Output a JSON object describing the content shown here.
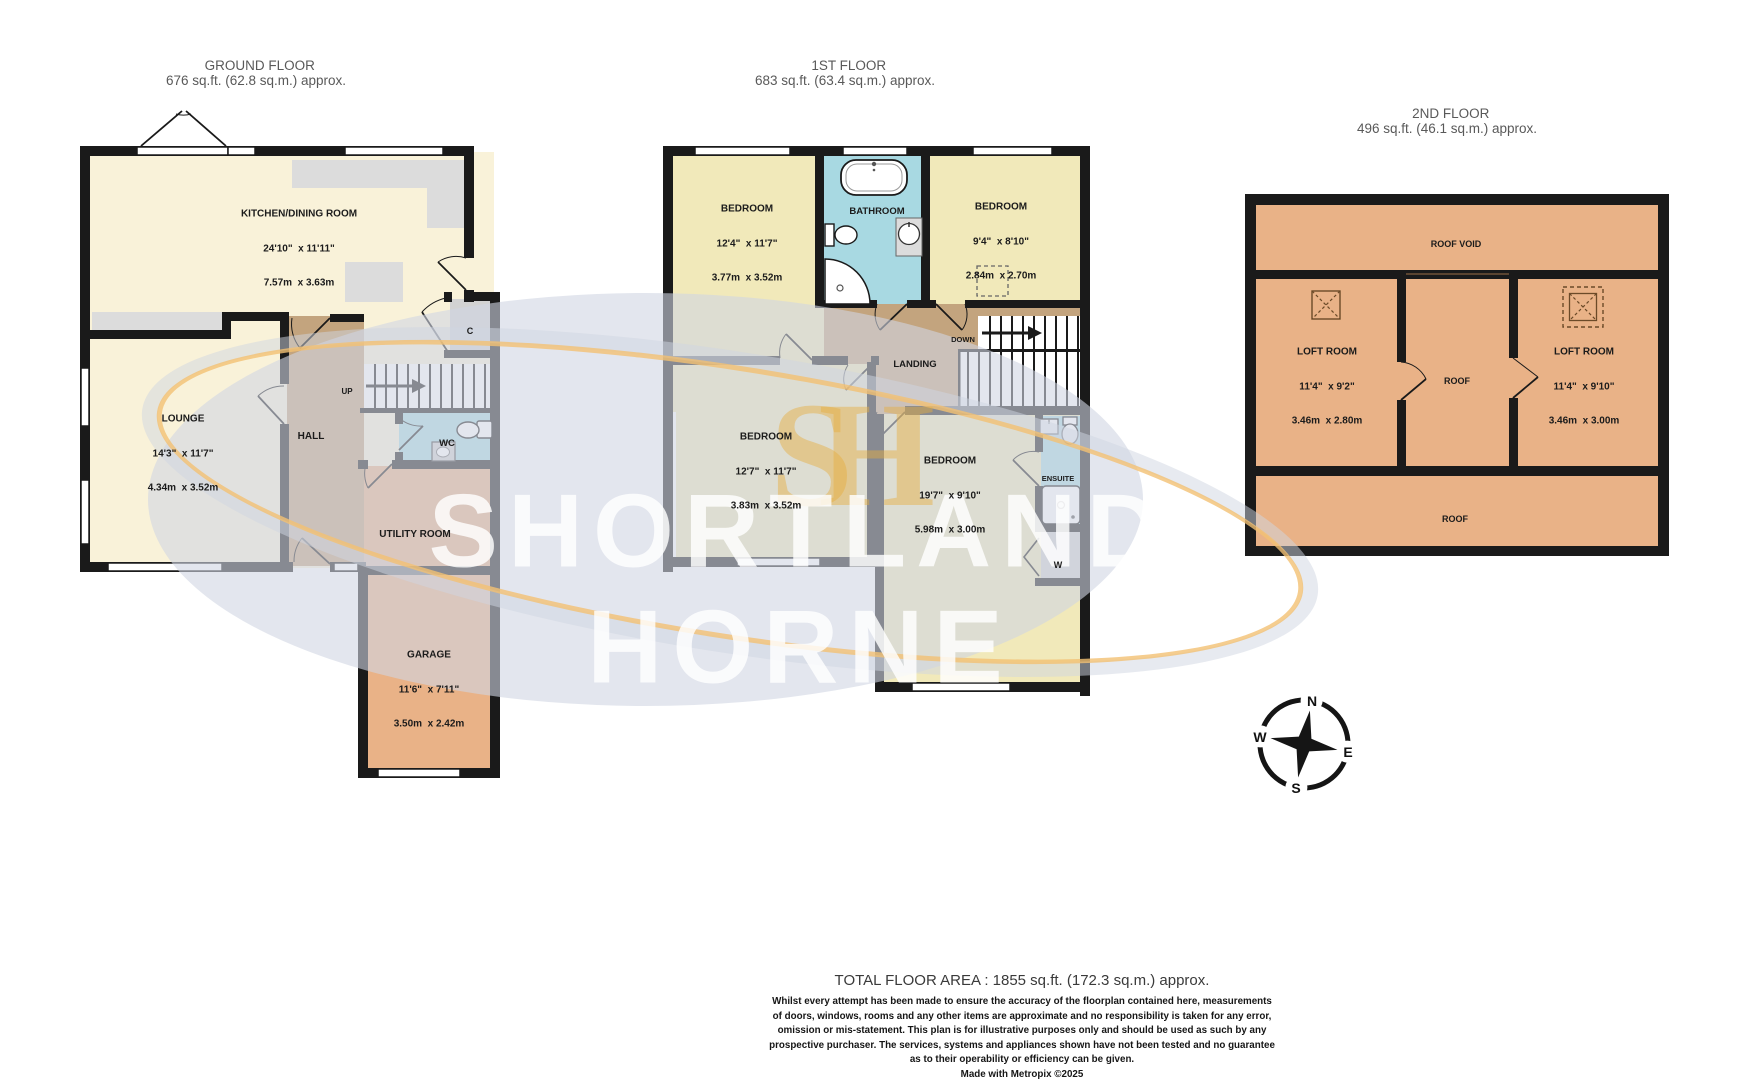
{
  "watermark": {
    "line1": "SHORTLAND",
    "line2": "HORNE",
    "monogram": "SH"
  },
  "compass": {
    "north": "N",
    "east": "E",
    "south": "S",
    "west": "W"
  },
  "floors": {
    "ground": {
      "title": "GROUND FLOOR",
      "area": "676 sq.ft. (62.8 sq.m.) approx.",
      "kitchen": {
        "name": "KITCHEN/DINING ROOM",
        "imperial": "24'10\"  x 11'11\"",
        "metric": "7.57m  x 3.63m"
      },
      "lounge": {
        "name": "LOUNGE",
        "imperial": "14'3\"  x 11'7\"",
        "metric": "4.34m  x 3.52m"
      },
      "hall": {
        "name": "HALL"
      },
      "stairs_label": "UP",
      "wc": {
        "name": "WC"
      },
      "cupboard": {
        "name": "C"
      },
      "utility": {
        "name": "UTILITY ROOM"
      },
      "garage": {
        "name": "GARAGE",
        "imperial": "11'6\"  x 7'11\"",
        "metric": "3.50m  x 2.42m"
      }
    },
    "first": {
      "title": "1ST FLOOR",
      "area": "683 sq.ft. (63.4 sq.m.) approx.",
      "bedroom1": {
        "name": "BEDROOM",
        "imperial": "12'4\"  x 11'7\"",
        "metric": "3.77m  x 3.52m"
      },
      "bathroom": {
        "name": "BATHROOM"
      },
      "bedroom2": {
        "name": "BEDROOM",
        "imperial": "9'4\"  x 8'10\"",
        "metric": "2.84m  x 2.70m"
      },
      "landing": {
        "name": "LANDING"
      },
      "stairs_label": "DOWN",
      "bedroom3": {
        "name": "BEDROOM",
        "imperial": "12'7\"  x 11'7\"",
        "metric": "3.83m  x 3.52m"
      },
      "bedroom4": {
        "name": "BEDROOM",
        "imperial": "19'7\"  x 9'10\"",
        "metric": "5.98m  x 3.00m"
      },
      "ensuite": {
        "name": "ENSUITE"
      },
      "wardrobe": {
        "name": "W"
      }
    },
    "second": {
      "title": "2ND FLOOR",
      "area": "496 sq.ft. (46.1 sq.m.) approx.",
      "roof_void": {
        "name": "ROOF VOID"
      },
      "loft_left": {
        "name": "LOFT ROOM",
        "imperial": "11'4\"  x 9'2\"",
        "metric": "3.46m  x 2.80m"
      },
      "roof_mid": {
        "name": "ROOF"
      },
      "loft_right": {
        "name": "LOFT ROOM",
        "imperial": "11'4\"  x 9'10\"",
        "metric": "3.46m  x 3.00m"
      },
      "roof_bottom": {
        "name": "ROOF"
      }
    }
  },
  "footer": {
    "total": "TOTAL FLOOR AREA : 1855 sq.ft. (172.3 sq.m.) approx.",
    "disclaimer": [
      "Whilst every attempt has been made to ensure the accuracy of the floorplan contained here, measurements",
      "of doors, windows, rooms and any other items are approximate and no responsibility is taken for any error,",
      "omission or mis-statement. This plan is for illustrative purposes only and should be used as such by any",
      "prospective purchaser. The services, systems and appliances shown have not been tested and no guarantee",
      "as to their operability or efficiency can be given.",
      "Made with Metropix ©2025"
    ]
  },
  "colors": {
    "wall": "#1a1a1a",
    "cream": "#f9f2d9",
    "yellow": "#f1e9ba",
    "tan": "#c3a47e",
    "orange": "#e9b287",
    "blue": "#a8d9e2",
    "counter": "#dcdcdc",
    "gold": "#f2c173"
  }
}
